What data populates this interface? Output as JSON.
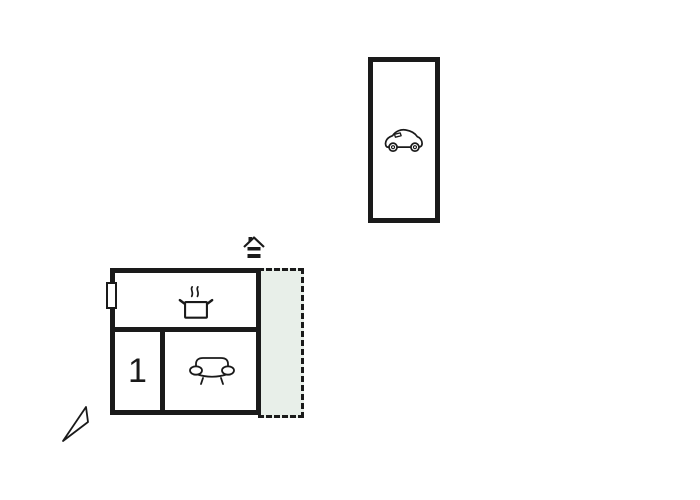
{
  "colors": {
    "line": "#1a1a1a",
    "terrace_fill": "#e8efe9",
    "background": "#ffffff"
  },
  "plan": {
    "garage": {
      "name": "garage",
      "icon": "car-icon"
    },
    "house": {
      "rooms": {
        "kitchen": {
          "name": "kitchen",
          "icon": "cooking-pot-icon"
        },
        "room1": {
          "name": "room 1",
          "label": "1"
        },
        "living": {
          "name": "living room",
          "icon": "sofa-icon"
        }
      },
      "window": {
        "name": "window"
      },
      "entrance": {
        "icon": "entrance-house-icon"
      }
    },
    "terrace": {
      "name": "terrace",
      "border_style": "dashed"
    },
    "compass": {
      "icon": "north-arrow-icon"
    }
  }
}
